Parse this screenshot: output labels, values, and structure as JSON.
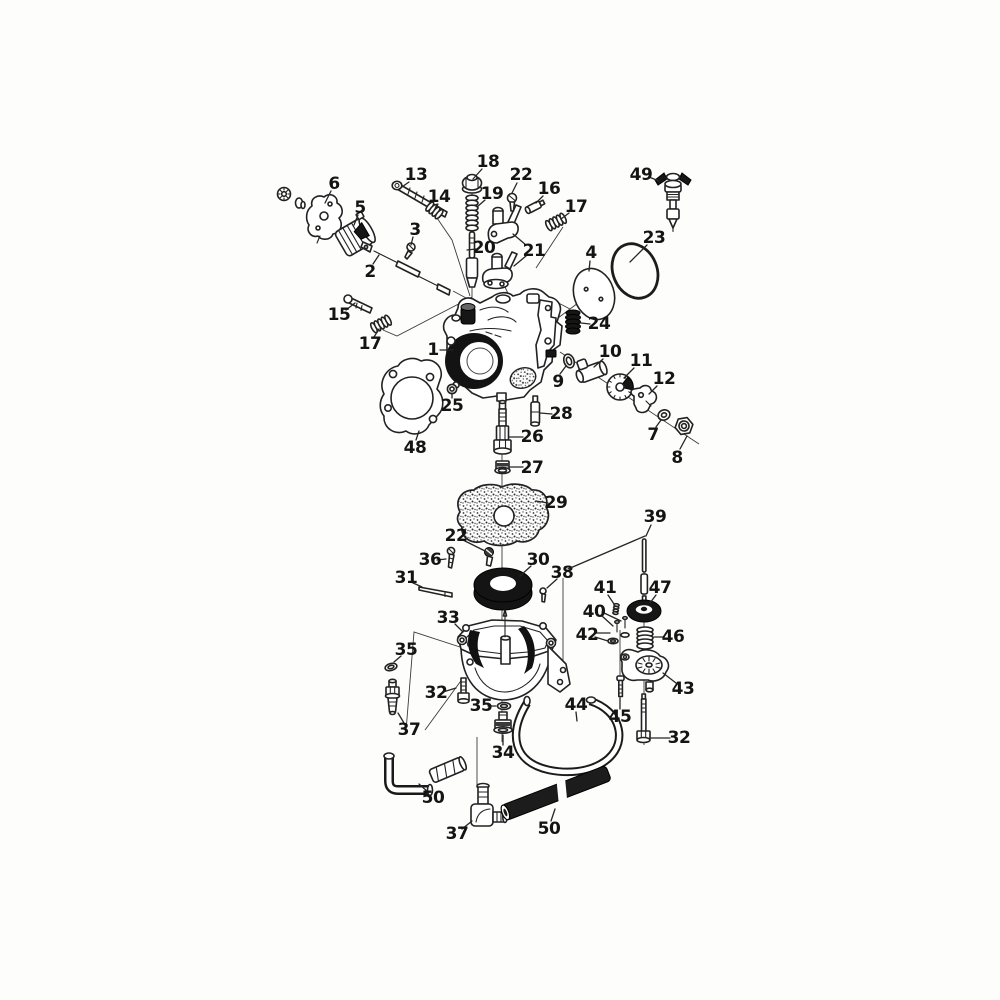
{
  "figure": {
    "kind": "exploded-parts-diagram",
    "background": "#fdfdfc",
    "ink": "#222222",
    "label_color": "#141414",
    "callouts": [
      {
        "label": "6",
        "x": 334,
        "y": 184,
        "leaders": [
          [
            331,
            191,
            325,
            203
          ]
        ]
      },
      {
        "label": "13",
        "x": 416,
        "y": 175,
        "leaders": [
          [
            409,
            182,
            399,
            189
          ]
        ]
      },
      {
        "label": "14",
        "x": 439,
        "y": 197,
        "leaders": [
          [
            437,
            204,
            434,
            211
          ]
        ]
      },
      {
        "label": "18",
        "x": 488,
        "y": 162,
        "leaders": [
          [
            482,
            169,
            473,
            179
          ]
        ]
      },
      {
        "label": "19",
        "x": 492,
        "y": 194,
        "leaders": [
          [
            485,
            200,
            477,
            207
          ]
        ]
      },
      {
        "label": "22",
        "x": 521,
        "y": 175,
        "leaders": [
          [
            517,
            183,
            512,
            193
          ]
        ]
      },
      {
        "label": "16",
        "x": 549,
        "y": 189,
        "leaders": [
          [
            543,
            196,
            536,
            203
          ]
        ]
      },
      {
        "label": "17",
        "x": 576,
        "y": 207,
        "leaders": [
          [
            569,
            213,
            561,
            219
          ]
        ]
      },
      {
        "label": "49",
        "x": 641,
        "y": 175,
        "leaders": [
          [
            649,
            177,
            659,
            181
          ]
        ]
      },
      {
        "label": "5",
        "x": 360,
        "y": 208,
        "leaders": [
          [
            358,
            215,
            354,
            225
          ]
        ]
      },
      {
        "label": "3",
        "x": 415,
        "y": 230,
        "leaders": [
          [
            413,
            237,
            411,
            245
          ]
        ]
      },
      {
        "label": "20",
        "x": 484,
        "y": 248,
        "leaders": [
          [
            476,
            249,
            467,
            250
          ]
        ]
      },
      {
        "label": "21",
        "x": 534,
        "y": 251,
        "leaders": [
          [
            526,
            245,
            513,
            234
          ],
          [
            526,
            256,
            514,
            266
          ]
        ]
      },
      {
        "label": "2",
        "x": 370,
        "y": 272,
        "leaders": [
          [
            373,
            264,
            379,
            255
          ]
        ]
      },
      {
        "label": "15",
        "x": 339,
        "y": 315,
        "leaders": [
          [
            346,
            310,
            355,
            303
          ]
        ]
      },
      {
        "label": "17",
        "x": 370,
        "y": 344,
        "leaders": [
          [
            374,
            337,
            379,
            329
          ]
        ]
      },
      {
        "label": "4",
        "x": 591,
        "y": 253,
        "leaders": [
          [
            590,
            261,
            589,
            271
          ]
        ]
      },
      {
        "label": "23",
        "x": 654,
        "y": 238,
        "leaders": [
          [
            647,
            245,
            630,
            262
          ]
        ]
      },
      {
        "label": "24",
        "x": 599,
        "y": 324,
        "leaders": [
          [
            590,
            324,
            581,
            323
          ]
        ]
      },
      {
        "label": "1",
        "x": 433,
        "y": 350,
        "leaders": [
          [
            440,
            350,
            453,
            350
          ]
        ]
      },
      {
        "label": "10",
        "x": 610,
        "y": 352,
        "leaders": [
          [
            603,
            359,
            594,
            367
          ]
        ]
      },
      {
        "label": "11",
        "x": 641,
        "y": 361,
        "leaders": [
          [
            634,
            368,
            624,
            378
          ]
        ]
      },
      {
        "label": "9",
        "x": 558,
        "y": 382,
        "leaders": [
          [
            560,
            374,
            566,
            366
          ]
        ]
      },
      {
        "label": "12",
        "x": 664,
        "y": 379,
        "leaders": [
          [
            657,
            386,
            649,
            394
          ]
        ]
      },
      {
        "label": "7",
        "x": 653,
        "y": 435,
        "leaders": [
          [
            656,
            427,
            661,
            420
          ]
        ]
      },
      {
        "label": "8",
        "x": 677,
        "y": 458,
        "leaders": [
          [
            680,
            449,
            687,
            436
          ]
        ]
      },
      {
        "label": "25",
        "x": 452,
        "y": 406,
        "leaders": [
          [
            452,
            398,
            452,
            393
          ]
        ]
      },
      {
        "label": "28",
        "x": 561,
        "y": 414,
        "leaders": [
          [
            552,
            414,
            540,
            413
          ]
        ]
      },
      {
        "label": "26",
        "x": 532,
        "y": 437,
        "leaders": [
          [
            523,
            437,
            509,
            437
          ]
        ]
      },
      {
        "label": "27",
        "x": 532,
        "y": 468,
        "leaders": [
          [
            523,
            467,
            510,
            467
          ]
        ]
      },
      {
        "label": "48",
        "x": 415,
        "y": 448,
        "leaders": [
          [
            416,
            440,
            419,
            431
          ]
        ]
      },
      {
        "label": "29",
        "x": 556,
        "y": 503,
        "leaders": [
          [
            548,
            503,
            536,
            501
          ]
        ]
      },
      {
        "label": "22",
        "x": 456,
        "y": 536,
        "leaders": [
          [
            463,
            540,
            485,
            551
          ]
        ]
      },
      {
        "label": "36",
        "x": 430,
        "y": 560,
        "leaders": [
          [
            437,
            560,
            446,
            559
          ]
        ]
      },
      {
        "label": "31",
        "x": 406,
        "y": 578,
        "leaders": [
          [
            411,
            582,
            422,
            587
          ]
        ]
      },
      {
        "label": "30",
        "x": 538,
        "y": 560,
        "leaders": [
          [
            531,
            566,
            520,
            576
          ]
        ]
      },
      {
        "label": "38",
        "x": 562,
        "y": 573,
        "leaders": [
          [
            557,
            579,
            547,
            588
          ]
        ]
      },
      {
        "label": "39",
        "x": 655,
        "y": 517,
        "leaders": [
          [
            651,
            525,
            646,
            536
          ],
          [
            645,
            536,
            568,
            569
          ]
        ]
      },
      {
        "label": "41",
        "x": 605,
        "y": 588,
        "leaders": [
          [
            608,
            595,
            614,
            604
          ]
        ]
      },
      {
        "label": "40",
        "x": 594,
        "y": 612,
        "leaders": [
          [
            602,
            612,
            621,
            621
          ],
          [
            602,
            616,
            613,
            626
          ]
        ]
      },
      {
        "label": "47",
        "x": 660,
        "y": 588,
        "leaders": [
          [
            656,
            595,
            650,
            603
          ]
        ]
      },
      {
        "label": "42",
        "x": 587,
        "y": 635,
        "leaders": [
          [
            595,
            633,
            610,
            633
          ],
          [
            595,
            637,
            608,
            641
          ]
        ]
      },
      {
        "label": "46",
        "x": 673,
        "y": 637,
        "leaders": [
          [
            664,
            637,
            654,
            637
          ]
        ]
      },
      {
        "label": "43",
        "x": 683,
        "y": 689,
        "leaders": [
          [
            676,
            683,
            663,
            673
          ]
        ]
      },
      {
        "label": "45",
        "x": 620,
        "y": 717,
        "leaders": [
          [
            620,
            709,
            620,
            698
          ]
        ]
      },
      {
        "label": "32",
        "x": 679,
        "y": 738,
        "leaders": [
          [
            670,
            738,
            651,
            738
          ]
        ]
      },
      {
        "label": "33",
        "x": 448,
        "y": 618,
        "leaders": [
          [
            455,
            624,
            463,
            632
          ]
        ]
      },
      {
        "label": "35",
        "x": 406,
        "y": 650,
        "leaders": [
          [
            401,
            656,
            394,
            662
          ]
        ]
      },
      {
        "label": "32",
        "x": 436,
        "y": 693,
        "leaders": [
          [
            443,
            692,
            456,
            688
          ]
        ]
      },
      {
        "label": "35",
        "x": 481,
        "y": 706,
        "leaders": [
          [
            488,
            706,
            496,
            706
          ]
        ]
      },
      {
        "label": "37",
        "x": 409,
        "y": 730,
        "leaders": [
          [
            404,
            723,
            398,
            713
          ]
        ]
      },
      {
        "label": "34",
        "x": 503,
        "y": 753,
        "leaders": [
          [
            503,
            745,
            503,
            735
          ]
        ]
      },
      {
        "label": "44",
        "x": 576,
        "y": 705,
        "leaders": [
          [
            576,
            712,
            577,
            721
          ]
        ]
      },
      {
        "label": "50",
        "x": 433,
        "y": 798,
        "leaders": [
          [
            428,
            792,
            419,
            784
          ]
        ]
      },
      {
        "label": "37",
        "x": 457,
        "y": 834,
        "leaders": [
          [
            462,
            829,
            472,
            821
          ]
        ]
      },
      {
        "label": "50",
        "x": 549,
        "y": 829,
        "leaders": [
          [
            551,
            821,
            555,
            809
          ]
        ]
      }
    ]
  }
}
